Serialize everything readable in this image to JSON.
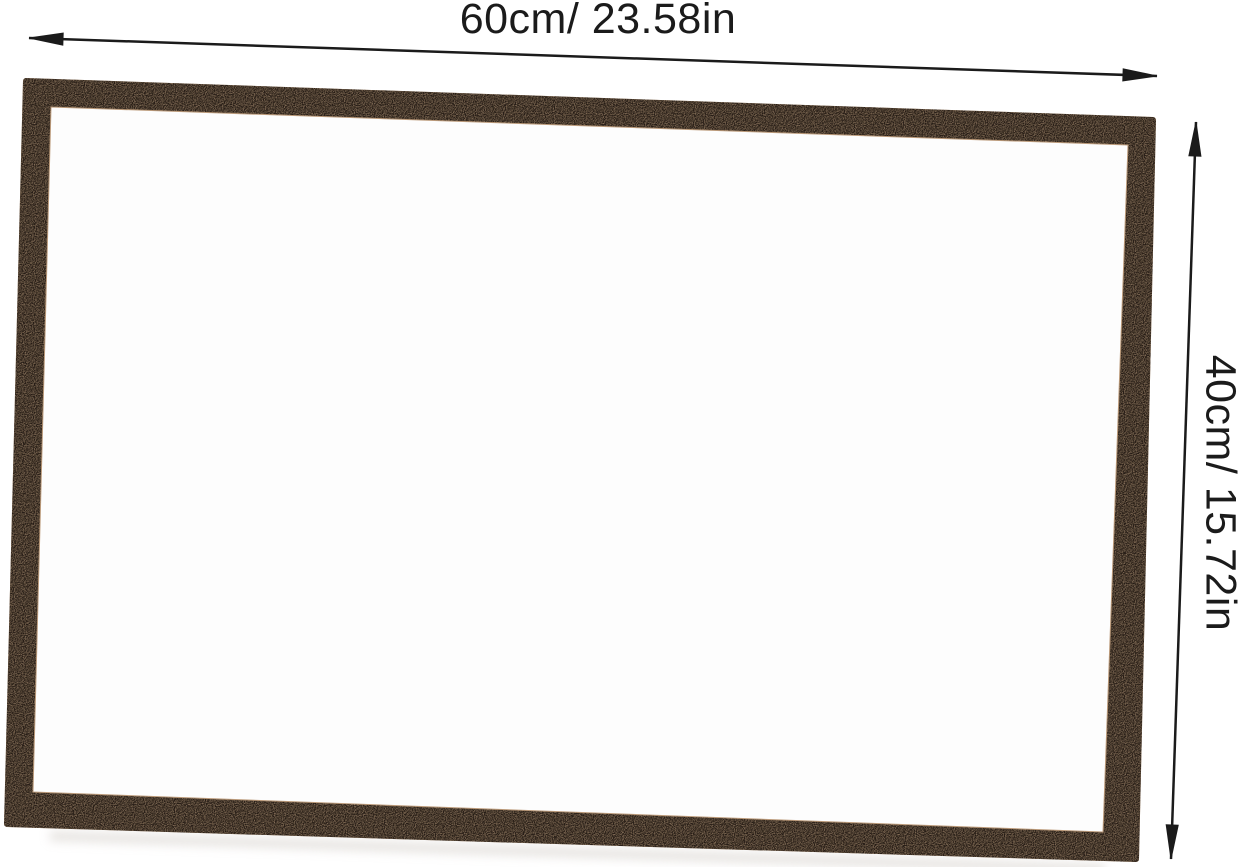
{
  "diagram": {
    "type": "product-dimension-diagram",
    "subject": "wood-framed whiteboard, front view"
  },
  "board": {
    "frame_color": "#c2a283",
    "surface_color": "#fdfdfd"
  },
  "annotations": {
    "width": {
      "label": "60cm/ 23.58in",
      "cm": "60cm",
      "inches": "23.58in",
      "orientation": "horizontal"
    },
    "height": {
      "label": "40cm/ 15.72in",
      "cm": "40cm",
      "inches": "15.72in",
      "orientation": "vertical"
    }
  },
  "colors": {
    "background": "#ffffff",
    "frame": "#c2a283",
    "frame_edge": "#bb9a7a",
    "surface": "#fdfdfd",
    "arrow": "#1b1b1b",
    "text": "#1b1b1b",
    "shadow": "#d3cec8"
  }
}
